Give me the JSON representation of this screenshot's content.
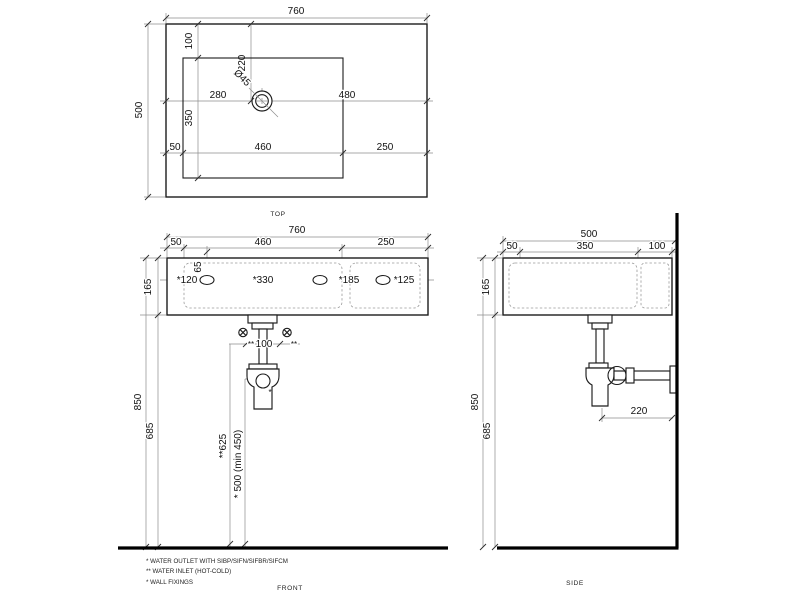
{
  "views": {
    "top": {
      "label": "TOP",
      "overall_width": "760",
      "overall_depth": "500",
      "rim_to_bowl_top": "100",
      "hole_from_top_edge": "220",
      "hole_diameter": "Ø45",
      "hole_from_left_edge": "280",
      "hole_to_right_edge": "480",
      "bowl_depth": "350",
      "rim_left": "50",
      "bowl_width": "460",
      "deck_width": "250"
    },
    "front": {
      "label": "FRONT",
      "overall_width": "760",
      "rim_left": "50",
      "bowl_width": "460",
      "deck_width": "250",
      "body_height": "165",
      "fixing_drop": "65",
      "fixing_pitch_1": "*120",
      "fixing_pitch_2": "*330",
      "fixing_pitch_3": "*185",
      "fixing_pitch_4": "*125",
      "inlet_mark_left": "**",
      "inlet_spacing": "100",
      "inlet_mark_right": "**",
      "outlet_mark": "*",
      "top_height": "850",
      "underside_height": "685",
      "inlet_height": "**625",
      "outlet_height": "* 500 (min 450)"
    },
    "side": {
      "label": "SIDE",
      "overall_depth": "500",
      "front_rim": "50",
      "bowl_depth": "350",
      "back_deck": "100",
      "body_height": "165",
      "top_height": "850",
      "underside_height": "685",
      "trap_to_wall": "220"
    }
  },
  "notes": [
    "* WATER OUTLET WITH SIBP/SIFN/SIFBR/SIFCM",
    "** WATER INLET  (HOT-COLD)",
    "* WALL FIXINGS"
  ]
}
